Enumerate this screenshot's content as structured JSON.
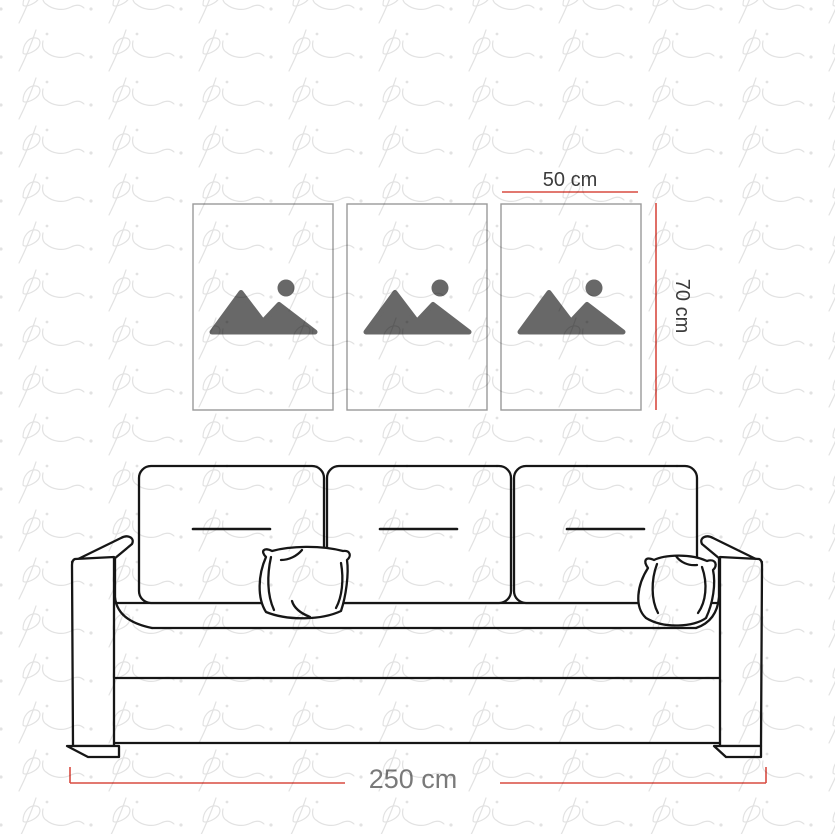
{
  "watermark": {
    "text": "pi",
    "color": "#e2e2e2"
  },
  "labels": {
    "frame_width": "50 cm",
    "frame_height": "70 cm",
    "sofa_width": "250 cm"
  },
  "colors": {
    "dimension_line": "#d94b41",
    "dimension_text_dark": "#3b3b3b",
    "dimension_text_gray": "#7a7a7a",
    "artwork_line": "#161616",
    "frame_border": "#9a9a9a",
    "icon_fill": "#686868",
    "background": "#ffffff"
  },
  "frames": {
    "count": 3,
    "icon": "image-placeholder"
  }
}
